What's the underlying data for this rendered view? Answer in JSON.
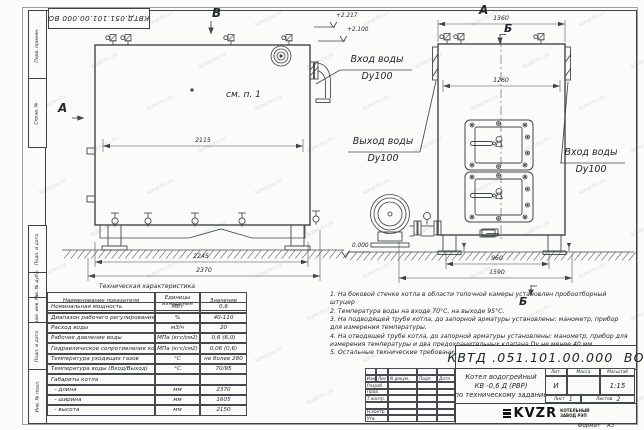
{
  "stamp_top": "КВТД.051.101.00.000 ВО",
  "watermark_text": "kotel-kv.ru",
  "side_labels": [
    "Перв. примен.",
    "Справ. №",
    "Подп. и дата",
    "Инв. № дубл.",
    "Взам. инв. №",
    "Подп. и дата",
    "Инв. № подл."
  ],
  "markers": {
    "v": "В",
    "a_left": "А",
    "a_top": "А",
    "b_top": "Б",
    "b_bottom": "Б",
    "see_note": "см. п. 1"
  },
  "elevations": {
    "top1": "+2.217",
    "top2": "+2.100",
    "zero": "0.000"
  },
  "dims": {
    "d2115": "2115",
    "d2245": "2245",
    "d2370": "2370",
    "d1360": "1360",
    "d1260": "1260",
    "d960": "960",
    "d1590": "1590"
  },
  "pipe_labels": {
    "inlet_top": "Вход воды",
    "inlet_top_dn": "Dy100",
    "outlet": "Выход воды",
    "outlet_dn": "Dy100",
    "inlet_right": "Вход воды",
    "inlet_right_dn": "Dy100"
  },
  "tech_table": {
    "title": "Техническая характеристика",
    "headers": {
      "name": "Наименование показателя",
      "units1": "Единицы",
      "units2": "измерения",
      "value": "Значение"
    },
    "rows": [
      {
        "name": "Номинальная мощность",
        "units": "МВт",
        "value": "0,6"
      },
      {
        "name": "Диапазон рабочего регулирования",
        "units": "%",
        "value": "40-110"
      },
      {
        "name": "Расход воды",
        "units": "м3/ч",
        "value": "20"
      },
      {
        "name": "Рабочее давление воды",
        "units": "МПа (кгс/см2)",
        "value": "0,6 (6,0)"
      },
      {
        "name": "Гидравлическое сопротивление котла",
        "units": "МПа (кгс/см2)",
        "value": "0,06 (0,6)"
      },
      {
        "name": "Температура уходящих газов",
        "units": "°С",
        "value": "не более 280"
      },
      {
        "name": "Температура воды (Вход/Выход)",
        "units": "°С",
        "value": "70/95"
      },
      {
        "name": "Габариты котла",
        "units": "",
        "value": ""
      },
      {
        "name": "  - длина",
        "units": "мм",
        "value": "2370"
      },
      {
        "name": "  - ширина",
        "units": "мм",
        "value": "1605"
      },
      {
        "name": "  - высота",
        "units": "мм",
        "value": "2150"
      }
    ]
  },
  "notes": [
    "1.  На боковой стенке котла в области топочной камеры установлен пробоотборный штуцер",
    "2.  Температура воды на входе 70°С, на выходе 95°С.",
    "3.  На подводящей трубе котла, до запорной арматуры установлены: манометр, прибор для измерения температуры.",
    "4.  На отводящей трубе котла, до запорной арматуры установлены: манометр, прибор для измерения температуры и два предохранительных клапана  Dу не менее 40 мм.",
    "5.  Остальные технические требования по ОСТ 108.030.133-84."
  ],
  "title_block": {
    "code": "КВТД .051.101.00.000  ВО",
    "name_line1": "Котел водогрейный",
    "name_line2": "КВ -0,6  Д  (РВР)",
    "name_line3": "по техническому задание",
    "lit_header": "Лит.",
    "mass_header": "Масса",
    "scale_header": "Масштаб",
    "lit_value": "И",
    "mass_value": "",
    "scale_value": "1:15",
    "sheet_label": "Лист",
    "sheet_value": "1",
    "sheets_label": "Листов",
    "sheets_value": "2",
    "rev_headers": [
      "Изм.",
      "Лист",
      "N докум.",
      "Подп.",
      "Дата"
    ],
    "row_labels": [
      "Разраб.",
      "Пров.",
      "Т.контр.",
      "",
      "Н.контр.",
      "Утв."
    ],
    "logo_text": "KVZR",
    "logo_sub1": "КОТЕЛЬНЫЙ",
    "logo_sub2": "ЗАВОД РЭП",
    "format_label": "Формат    А3"
  }
}
